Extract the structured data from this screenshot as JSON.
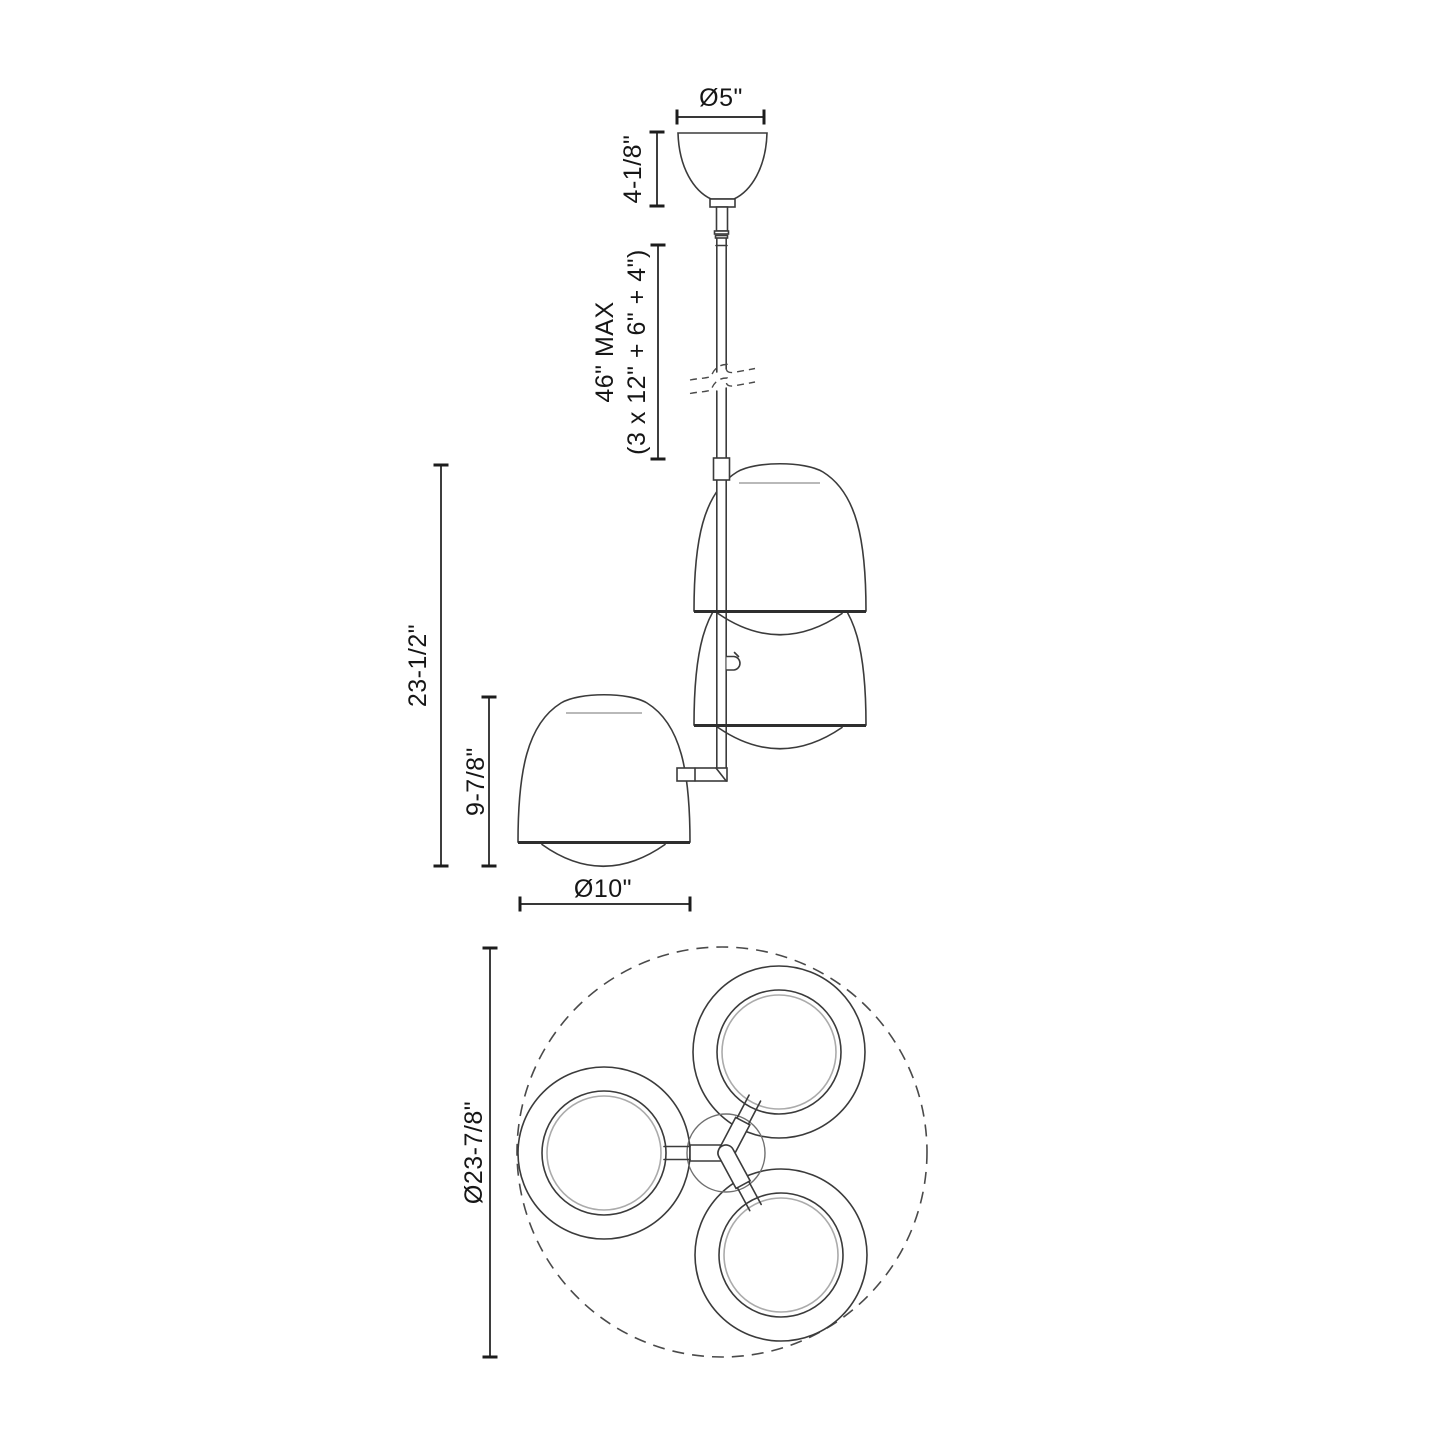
{
  "colors": {
    "background": "#ffffff",
    "drawing_line": "#3b3b3b",
    "dimension_line": "#1c1c1c",
    "text": "#161616"
  },
  "elevation_view": {
    "canopy_diameter": "Ø5\"",
    "canopy_height": "4-1/8\"",
    "rod_max_length": "46\" MAX",
    "rod_section_breakdown": "(3 x 12\" + 6\" + 4\")",
    "body_height": "23-1/2\"",
    "shade_height": "9-7/8\"",
    "shade_diameter": "Ø10\""
  },
  "plan_view": {
    "overall_diameter": "Ø23-7/8\""
  }
}
